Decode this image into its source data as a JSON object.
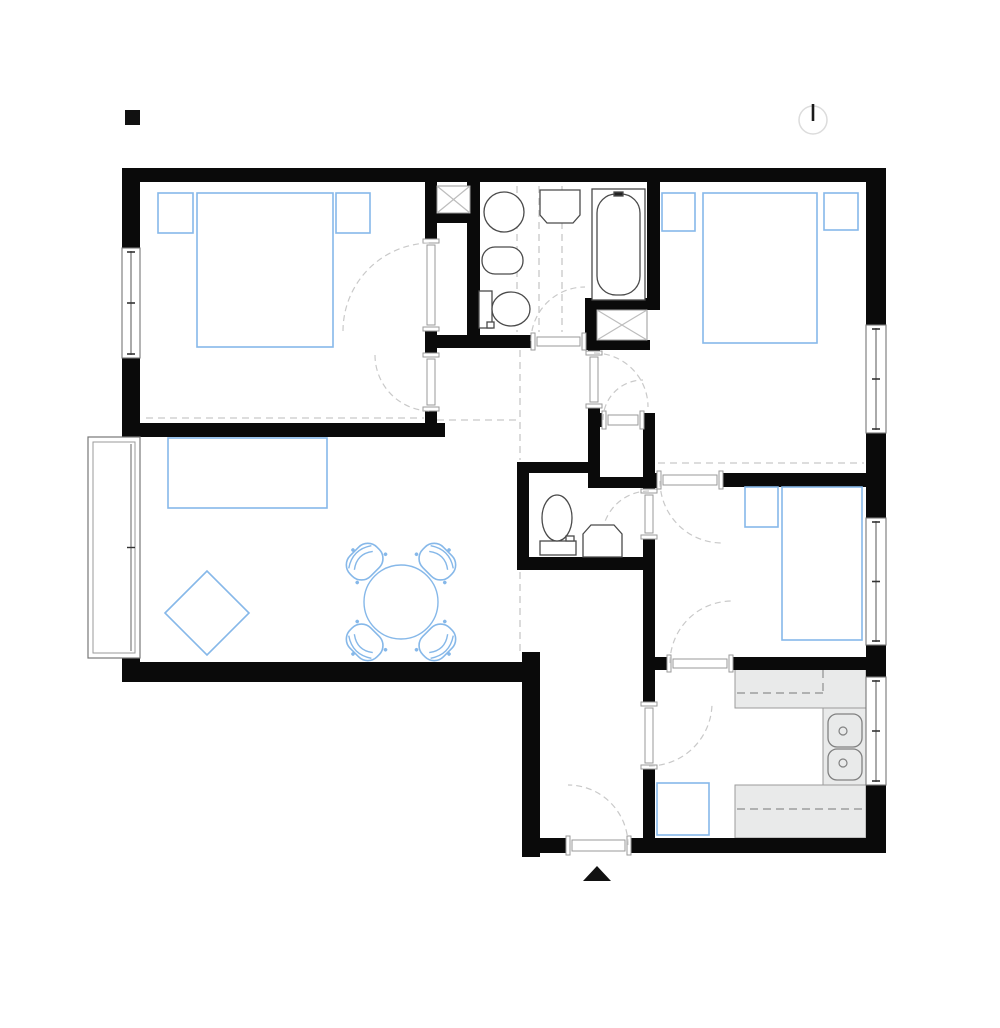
{
  "title": "apartment-floor-plan",
  "canvas": {
    "w": 1000,
    "h": 1028,
    "bg": "#ffffff"
  },
  "colors": {
    "wall": "#0a0a0a",
    "furniture_blue": "#86b8e9",
    "fixture_gray": "#4a4a4a",
    "counter_fill": "#e9eaea",
    "counter_stroke": "#9b9b9b",
    "frame_gray": "#9a9a9a",
    "arc_gray": "#c9c9c9",
    "ceiling_dash": "#d2d2d2",
    "window_stroke": "#777777",
    "shaft_x": "#bdbdbd",
    "north_circle": "#dcdcdc"
  },
  "plan": {
    "markers": {
      "scale_square": {
        "n": "scale-marker-square",
        "x": 125,
        "y": 110,
        "w": 15,
        "h": 15
      },
      "north": {
        "n": "north-indicator",
        "cx": 813,
        "cy": 120,
        "r": 14,
        "line": [
          813,
          104,
          813,
          121
        ]
      },
      "entrance_arrow": {
        "n": "entrance-arrow",
        "points": "583,881 611,881 597,866"
      }
    },
    "dashes": [
      {
        "n": "ceiling-dash-bedroom1",
        "x1": 146,
        "y1": 418,
        "x2": 424,
        "y2": 418
      },
      {
        "n": "ceiling-dash-hall-top",
        "x1": 437,
        "y1": 420,
        "x2": 518,
        "y2": 420
      },
      {
        "n": "ceiling-dash-living-east-a",
        "x1": 520,
        "y1": 350,
        "x2": 520,
        "y2": 460
      },
      {
        "n": "ceiling-dash-living-east-b",
        "x1": 520,
        "y1": 560,
        "x2": 520,
        "y2": 656
      },
      {
        "n": "ceiling-dash-bath-a",
        "x1": 517,
        "y1": 186,
        "x2": 517,
        "y2": 332
      },
      {
        "n": "ceiling-dash-bath-b",
        "x1": 539,
        "y1": 186,
        "x2": 539,
        "y2": 332
      },
      {
        "n": "ceiling-dash-bath-c",
        "x1": 562,
        "y1": 186,
        "x2": 562,
        "y2": 332
      },
      {
        "n": "ceiling-dash-hall-center",
        "x1": 528,
        "y1": 464,
        "x2": 586,
        "y2": 464
      },
      {
        "n": "ceiling-dash-bedroom2",
        "x1": 658,
        "y1": 463,
        "x2": 864,
        "y2": 463
      }
    ],
    "counters": {
      "slabs": [
        {
          "n": "kitchen-counter-top",
          "x": 735,
          "y": 668,
          "w": 131,
          "h": 40
        },
        {
          "n": "kitchen-counter-right",
          "x": 823,
          "y": 708,
          "w": 43,
          "h": 79
        },
        {
          "n": "kitchen-counter-bottom",
          "x": 735,
          "y": 785,
          "w": 131,
          "h": 53
        }
      ],
      "dash_lines": [
        {
          "n": "kitchen-cabinet-dash-a",
          "x1": 737,
          "y1": 693,
          "x2": 823,
          "y2": 693
        },
        {
          "n": "kitchen-cabinet-dash-b",
          "x1": 823,
          "y1": 670,
          "x2": 823,
          "y2": 693
        },
        {
          "n": "kitchen-cabinet-dash-c",
          "x1": 737,
          "y1": 809,
          "x2": 864,
          "y2": 809
        }
      ],
      "sink": {
        "n": "kitchen-sink",
        "basins": [
          {
            "x": 828,
            "y": 714,
            "w": 34,
            "h": 33,
            "rx": 9
          },
          {
            "x": 828,
            "y": 749,
            "w": 34,
            "h": 31,
            "rx": 9
          }
        ],
        "drains": [
          {
            "cx": 843,
            "cy": 731,
            "r": 4
          },
          {
            "cx": 843,
            "cy": 763,
            "r": 4
          }
        ]
      }
    },
    "walls": [
      {
        "n": "wall-exterior-top",
        "x": 122,
        "y": 168,
        "w": 764,
        "h": 14
      },
      {
        "n": "wall-exterior-left-upper",
        "x": 122,
        "y": 182,
        "w": 18,
        "h": 66
      },
      {
        "n": "wall-exterior-left-mid",
        "x": 122,
        "y": 358,
        "w": 18,
        "h": 65
      },
      {
        "n": "wall-bedroom1-south",
        "x": 122,
        "y": 423,
        "w": 323,
        "h": 14
      },
      {
        "n": "wall-living-left-stub",
        "x": 122,
        "y": 658,
        "w": 18,
        "h": 24
      },
      {
        "n": "wall-living-south",
        "x": 122,
        "y": 662,
        "w": 418,
        "h": 20
      },
      {
        "n": "wall-hall-west",
        "x": 522,
        "y": 652,
        "w": 18,
        "h": 205
      },
      {
        "n": "wall-bottom-left",
        "x": 522,
        "y": 838,
        "w": 45,
        "h": 15
      },
      {
        "n": "wall-bottom-right",
        "x": 630,
        "y": 838,
        "w": 256,
        "h": 15
      },
      {
        "n": "wall-exterior-right-a",
        "x": 866,
        "y": 182,
        "w": 20,
        "h": 143
      },
      {
        "n": "wall-exterior-right-b",
        "x": 866,
        "y": 433,
        "w": 20,
        "h": 85
      },
      {
        "n": "wall-exterior-right-c",
        "x": 866,
        "y": 645,
        "w": 20,
        "h": 32
      },
      {
        "n": "wall-exterior-right-d",
        "x": 866,
        "y": 785,
        "w": 20,
        "h": 68
      },
      {
        "n": "wall-bedroom1-east-a",
        "x": 425,
        "y": 182,
        "w": 12,
        "h": 58
      },
      {
        "n": "wall-shaft1-south",
        "x": 425,
        "y": 213,
        "w": 45,
        "h": 10
      },
      {
        "n": "wall-bedroom1-east-b",
        "x": 425,
        "y": 330,
        "w": 12,
        "h": 24
      },
      {
        "n": "wall-bedroom1-east-c",
        "x": 425,
        "y": 410,
        "w": 12,
        "h": 27
      },
      {
        "n": "wall-bathroom-west",
        "x": 467,
        "y": 182,
        "w": 13,
        "h": 166
      },
      {
        "n": "wall-bathroom-south",
        "x": 425,
        "y": 335,
        "w": 107,
        "h": 13
      },
      {
        "n": "wall-bathroom-se",
        "x": 585,
        "y": 298,
        "w": 12,
        "h": 52
      },
      {
        "n": "wall-shaft2-north",
        "x": 585,
        "y": 298,
        "w": 65,
        "h": 12
      },
      {
        "n": "wall-shaft2-south",
        "x": 588,
        "y": 340,
        "w": 62,
        "h": 10
      },
      {
        "n": "wall-bathroom-east",
        "x": 647,
        "y": 182,
        "w": 13,
        "h": 128
      },
      {
        "n": "wall-lobby-west-stub-a",
        "x": 588,
        "y": 348,
        "w": 12,
        "h": 5
      },
      {
        "n": "wall-lobby-west-stub-b",
        "x": 588,
        "y": 407,
        "w": 12,
        "h": 7
      },
      {
        "n": "wall-closet-west",
        "x": 588,
        "y": 413,
        "w": 12,
        "h": 75
      },
      {
        "n": "wall-closet-north-stub-a",
        "x": 588,
        "y": 413,
        "w": 15,
        "h": 14
      },
      {
        "n": "wall-closet-north-stub-b",
        "x": 643,
        "y": 413,
        "w": 12,
        "h": 14
      },
      {
        "n": "wall-closet-east",
        "x": 643,
        "y": 413,
        "w": 12,
        "h": 70
      },
      {
        "n": "wall-closet-south",
        "x": 588,
        "y": 477,
        "w": 70,
        "h": 11
      },
      {
        "n": "wall-wc-west",
        "x": 517,
        "y": 462,
        "w": 12,
        "h": 98
      },
      {
        "n": "wall-wc-north",
        "x": 517,
        "y": 462,
        "w": 71,
        "h": 11
      },
      {
        "n": "wall-wc-south",
        "x": 517,
        "y": 557,
        "w": 138,
        "h": 13
      },
      {
        "n": "wall-wc-east-stub",
        "x": 643,
        "y": 483,
        "w": 12,
        "h": 7
      },
      {
        "n": "wall-hall-east",
        "x": 643,
        "y": 538,
        "w": 12,
        "h": 165
      },
      {
        "n": "wall-kitchen-west-lower",
        "x": 643,
        "y": 768,
        "w": 12,
        "h": 85
      },
      {
        "n": "wall-bedroom3-north-stub",
        "x": 643,
        "y": 473,
        "w": 15,
        "h": 14
      },
      {
        "n": "wall-bedroom3-north",
        "x": 722,
        "y": 473,
        "w": 144,
        "h": 14
      },
      {
        "n": "wall-bedroom3-south-stub",
        "x": 655,
        "y": 657,
        "w": 13,
        "h": 13
      },
      {
        "n": "wall-bedroom3-south",
        "x": 732,
        "y": 657,
        "w": 134,
        "h": 13
      }
    ],
    "shafts": [
      {
        "n": "duct-shaft-1",
        "x": 437,
        "y": 186,
        "w": 33,
        "h": 27
      },
      {
        "n": "duct-shaft-2",
        "x": 597,
        "y": 310,
        "w": 50,
        "h": 30
      }
    ],
    "windows": [
      {
        "n": "window-bedroom1-west",
        "x": 122,
        "y": 248,
        "w": 18,
        "h": 110
      },
      {
        "n": "window-bedroom2-east",
        "x": 866,
        "y": 325,
        "w": 20,
        "h": 108
      },
      {
        "n": "window-bedroom3-east",
        "x": 866,
        "y": 518,
        "w": 20,
        "h": 127
      },
      {
        "n": "window-kitchen-east",
        "x": 866,
        "y": 677,
        "w": 20,
        "h": 108
      }
    ],
    "balcony_door": {
      "n": "balcony-door",
      "x": 88,
      "y": 437,
      "w": 52,
      "h": 221
    },
    "doors": [
      {
        "n": "door-bedroom1-closet",
        "x": 425,
        "y": 240,
        "w": 12,
        "h": 90,
        "o": "v",
        "arc": "M 343 331 A 88 88 0 0 1 431 243"
      },
      {
        "n": "door-bedroom1",
        "x": 425,
        "y": 354,
        "w": 12,
        "h": 56,
        "o": "v",
        "arc": "M 375 355 A 56 56 0 0 0 431 411"
      },
      {
        "n": "door-bathroom",
        "x": 532,
        "y": 335,
        "w": 53,
        "h": 13,
        "o": "h",
        "arc": "M 531 341 A 54 54 0 0 1 585 287"
      },
      {
        "n": "door-bedroom2-lobby",
        "x": 588,
        "y": 352,
        "w": 12,
        "h": 55,
        "o": "v",
        "arc": "M 594 353 A 54 54 0 0 1 648 407"
      },
      {
        "n": "door-storage-closet",
        "x": 603,
        "y": 413,
        "w": 40,
        "h": 14,
        "o": "h",
        "arc": "M 603 420 A 40 40 0 0 1 643 380"
      },
      {
        "n": "door-wc",
        "x": 643,
        "y": 490,
        "w": 12,
        "h": 48,
        "o": "v",
        "arc": "M 649 491 A 47 47 0 0 0 602 538"
      },
      {
        "n": "door-bedroom3-north",
        "x": 658,
        "y": 473,
        "w": 64,
        "h": 14,
        "o": "h",
        "arc": "M 660 481 A 62 62 0 0 0 722 543"
      },
      {
        "n": "door-bedroom3-south",
        "x": 668,
        "y": 657,
        "w": 64,
        "h": 13,
        "o": "h",
        "arc": "M 670 663 A 62 62 0 0 1 732 601"
      },
      {
        "n": "door-kitchen",
        "x": 643,
        "y": 703,
        "w": 12,
        "h": 65,
        "o": "v",
        "arc": "M 649 766 A 63 63 0 0 0 712 703"
      },
      {
        "n": "door-entrance",
        "x": 567,
        "y": 838,
        "w": 63,
        "h": 15,
        "o": "h",
        "arc": "M 628 845 A 60 60 0 0 0 568 785"
      }
    ],
    "fixtures": [
      {
        "n": "bathroom-washbasin",
        "parts": [
          {
            "t": "circle",
            "cx": 504,
            "cy": 212,
            "r": 20
          }
        ]
      },
      {
        "n": "bathroom-bidet",
        "parts": [
          {
            "t": "rrect",
            "x": 482,
            "y": 247,
            "w": 41,
            "h": 27,
            "rx": 13
          }
        ]
      },
      {
        "n": "bathroom-toilet",
        "parts": [
          {
            "t": "rect",
            "x": 479,
            "y": 291,
            "w": 13,
            "h": 37
          },
          {
            "t": "ellipse",
            "cx": 511,
            "cy": 309,
            "rx": 19,
            "ry": 17
          },
          {
            "t": "rect",
            "x": 487,
            "y": 322,
            "w": 7,
            "h": 6
          }
        ]
      },
      {
        "n": "washing-machine",
        "parts": [
          {
            "t": "poly",
            "p": "540,190 580,190 580,215 573,223 547,223 540,215"
          }
        ]
      },
      {
        "n": "bathtub",
        "parts": [
          {
            "t": "rect",
            "x": 592,
            "y": 189,
            "w": 53,
            "h": 111
          },
          {
            "t": "rrect",
            "x": 597,
            "y": 194,
            "w": 43,
            "h": 101,
            "rx": 19
          },
          {
            "t": "rect",
            "x": 614,
            "y": 192,
            "w": 9,
            "h": 4,
            "f": "#222222"
          }
        ]
      },
      {
        "n": "wc-toilet",
        "parts": [
          {
            "t": "rect",
            "x": 540,
            "y": 541,
            "w": 36,
            "h": 14
          },
          {
            "t": "ellipse",
            "cx": 557,
            "cy": 518,
            "rx": 15,
            "ry": 23
          },
          {
            "t": "rect",
            "x": 566,
            "y": 536,
            "w": 8,
            "h": 5
          }
        ]
      },
      {
        "n": "wc-washbasin",
        "parts": [
          {
            "t": "poly",
            "p": "583,534 591,525 614,525 622,534 622,557 583,557"
          }
        ]
      }
    ],
    "furniture": [
      {
        "n": "bedroom1-nightstand-left",
        "t": "rect",
        "x": 158,
        "y": 193,
        "w": 35,
        "h": 40
      },
      {
        "n": "bedroom1-bed",
        "t": "rect",
        "x": 197,
        "y": 193,
        "w": 136,
        "h": 154
      },
      {
        "n": "bedroom1-nightstand-right",
        "t": "rect",
        "x": 336,
        "y": 193,
        "w": 34,
        "h": 40
      },
      {
        "n": "bedroom2-nightstand-left",
        "t": "rect",
        "x": 662,
        "y": 193,
        "w": 33,
        "h": 38
      },
      {
        "n": "bedroom2-bed",
        "t": "rect",
        "x": 703,
        "y": 193,
        "w": 114,
        "h": 150
      },
      {
        "n": "bedroom2-nightstand-right",
        "t": "rect",
        "x": 824,
        "y": 193,
        "w": 34,
        "h": 37
      },
      {
        "n": "bedroom3-nightstand",
        "t": "rect",
        "x": 745,
        "y": 487,
        "w": 33,
        "h": 40
      },
      {
        "n": "bedroom3-bed",
        "t": "rect",
        "x": 782,
        "y": 487,
        "w": 80,
        "h": 153
      },
      {
        "n": "sofa",
        "t": "rect",
        "x": 168,
        "y": 438,
        "w": 159,
        "h": 70
      },
      {
        "n": "pouf",
        "t": "poly",
        "p": "165,613 207,571 249,613 207,655"
      },
      {
        "n": "kitchen-table",
        "t": "rect",
        "x": 657,
        "y": 783,
        "w": 52,
        "h": 52
      }
    ],
    "dining": {
      "table": {
        "n": "dining-table",
        "cx": 401,
        "cy": 602,
        "r": 37
      },
      "chairs": [
        {
          "n": "dining-chair-nw",
          "cx": 365,
          "cy": 562,
          "rot": -45
        },
        {
          "n": "dining-chair-ne",
          "cx": 437,
          "cy": 562,
          "rot": 45
        },
        {
          "n": "dining-chair-se",
          "cx": 437,
          "cy": 642,
          "rot": 135
        },
        {
          "n": "dining-chair-sw",
          "cx": 365,
          "cy": 642,
          "rot": -135
        }
      ]
    }
  }
}
